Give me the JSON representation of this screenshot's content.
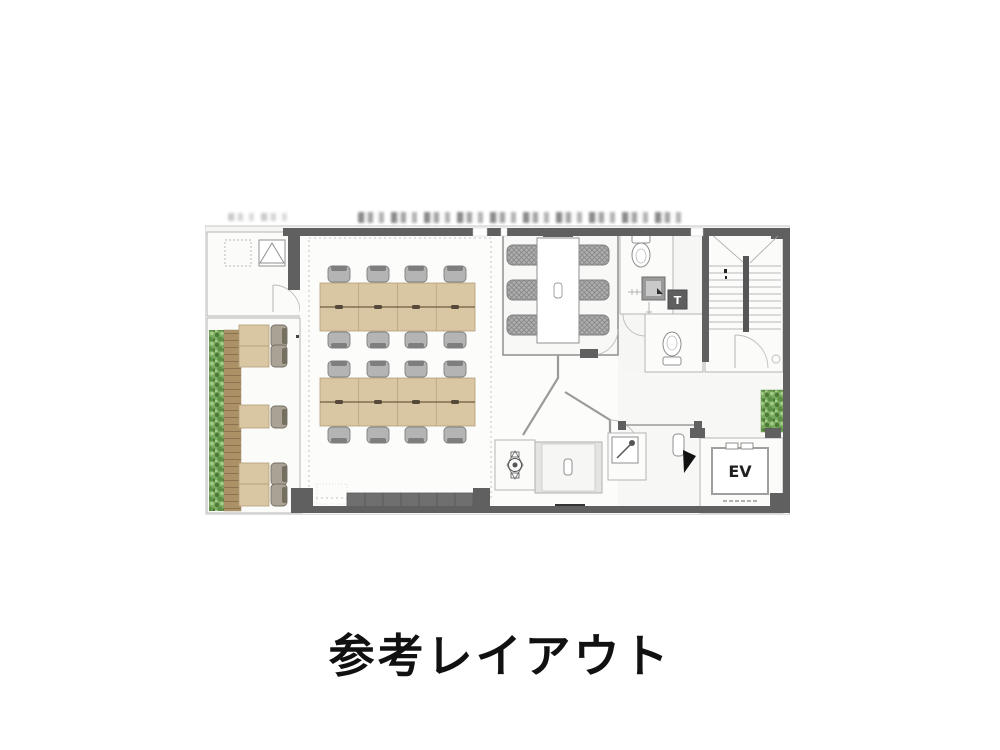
{
  "caption": {
    "text": "参考レイアウト"
  },
  "plan": {
    "title": "office-reference-floor-plan",
    "labels": {
      "elevator": "EV",
      "utility": "T"
    },
    "rooms": [
      "terrace-equipment-room",
      "balcony-window-counter",
      "open-office",
      "meeting-room",
      "toilet-upper",
      "toilet-lower",
      "stairwell",
      "pantry",
      "shower-room",
      "elevator"
    ],
    "furniture": {
      "desk_islands": 2,
      "seats_per_island": 8,
      "window_counter_seats": 5,
      "meeting_room_seats": 6,
      "bottom_cabinet_segments": 7
    },
    "colors": {
      "wall": "#606060",
      "desk": "#d9c7a3",
      "deskBorder": "#b39d77",
      "chair": "#b4b4b4",
      "chairBorder": "#7e7e7e",
      "deck": "#ac9166",
      "deckLine": "#8b7350",
      "plant": "#79aa5d",
      "plantDark": "#4c7a37",
      "cabinet": "#6f6f6f"
    }
  }
}
